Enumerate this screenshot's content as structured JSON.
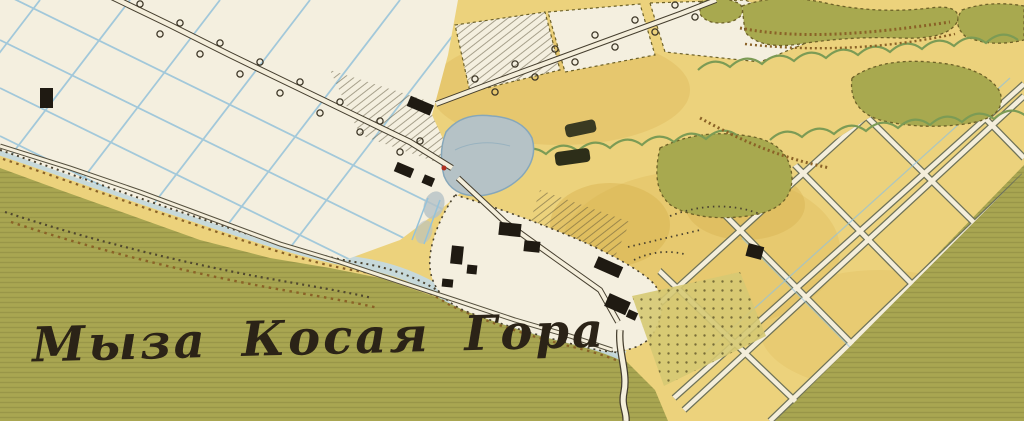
{
  "map": {
    "label": "Мыза Косая Гора",
    "label_meaning": "Kosaya Gora Manor",
    "colors": {
      "paper": "#f1ead6",
      "field": "#ecd27c",
      "field-shade": "#ddb85a",
      "meadow": "#a9a651",
      "white-ground": "#f4efdf",
      "water": "#b5c2c6",
      "water-edge": "#86a7ba",
      "ditch": "#94c2da",
      "shore-wash": "#c3d9e4",
      "road-fill": "#f4eedb",
      "road-casing": "#453e2e",
      "lattice-casing": "#6e7258",
      "building": "#1f1a12",
      "grove": "#a8a94f",
      "grove-edge": "#6d6128",
      "scrub": "#7c9b55",
      "ridge": "#8a6227",
      "stipple": "#4a422f",
      "ink": "#2b2317",
      "mark-red": "#b03020",
      "garden-dot": "#584f24",
      "garden-ground": "#d6c973"
    },
    "features": {
      "settlement": "manor-buildings",
      "water": "pond-and-stream",
      "road": "tree-lined-road",
      "field_grid": "allotment-lattice",
      "woods": "tree-grove",
      "grass": "meadow",
      "drainage": "ditch-grid",
      "bank": "stream-bank-stipple"
    }
  }
}
